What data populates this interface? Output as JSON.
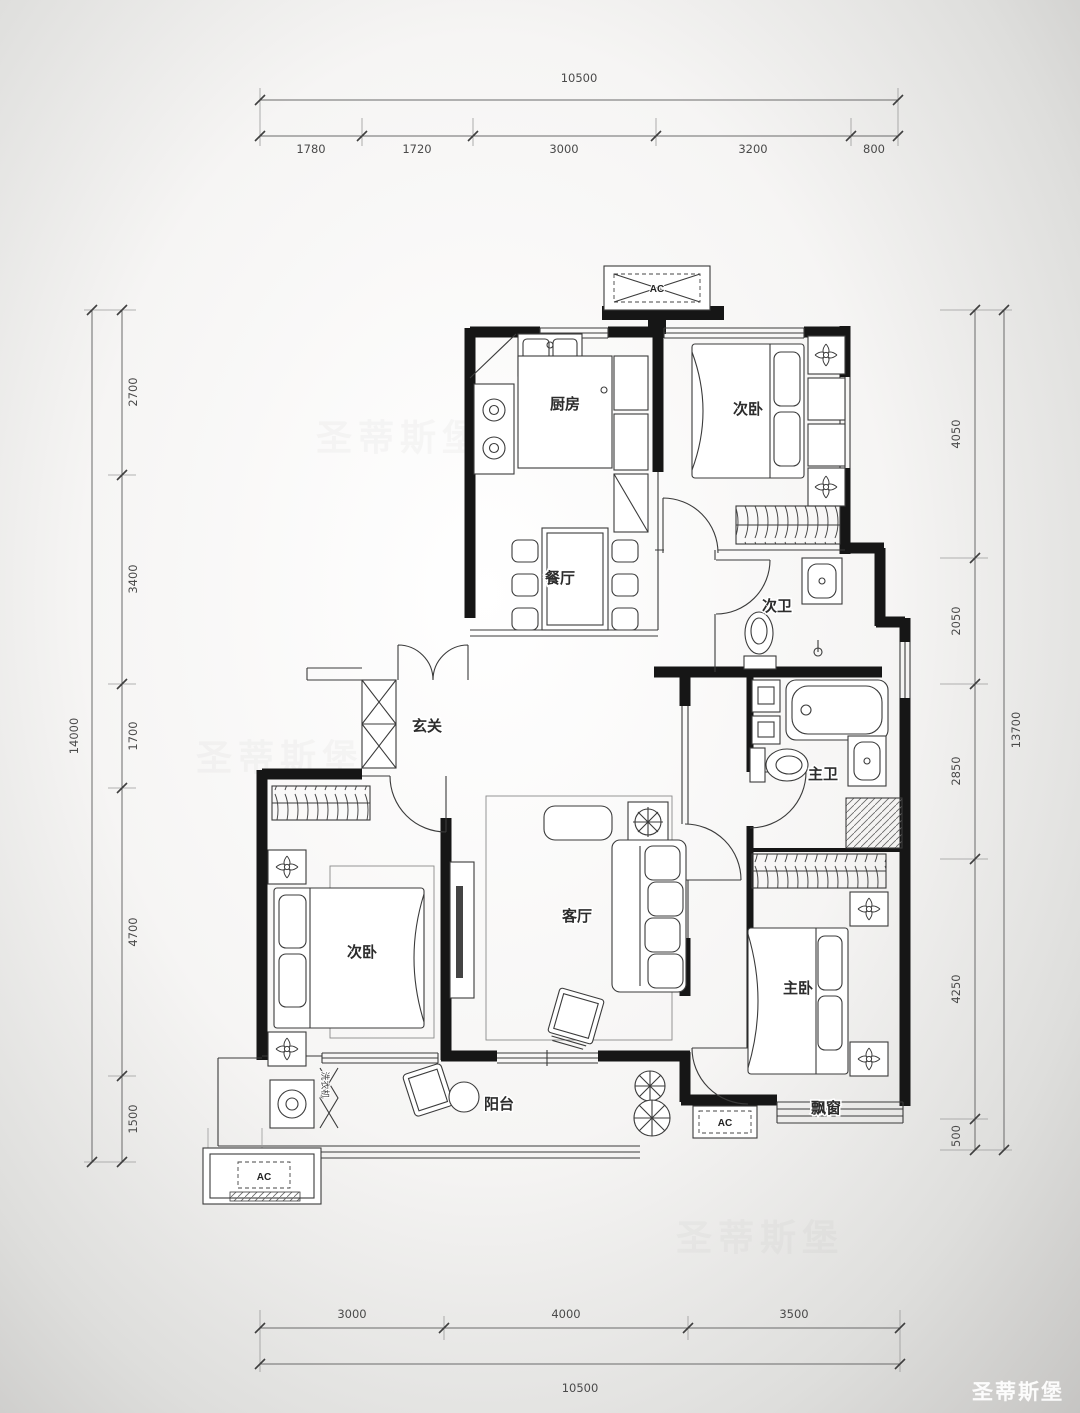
{
  "brand": "圣蒂斯堡",
  "rooms": {
    "kitchen": "厨房",
    "bedroom_top": "次卧",
    "dining": "餐厅",
    "bath_second": "次卫",
    "entry": "玄关",
    "living": "客厅",
    "bedroom_left": "次卧",
    "bath_master": "主卫",
    "bedroom_master": "主卧",
    "balcony": "阳台",
    "bay_window": "飘窗",
    "washer": "洗衣机",
    "ac": "AC"
  },
  "dims": {
    "top": {
      "total": "10500",
      "segments": [
        "1780",
        "1720",
        "3000",
        "3200",
        "800"
      ]
    },
    "bottom": {
      "total": "10500",
      "segments": [
        "3000",
        "4000",
        "3500"
      ]
    },
    "left": {
      "total": "14000",
      "segments": [
        "2700",
        "3400",
        "1700",
        "4700",
        "1500"
      ]
    },
    "right": {
      "total": "13700",
      "segments": [
        "4050",
        "2050",
        "2850",
        "4250",
        "500"
      ]
    }
  }
}
